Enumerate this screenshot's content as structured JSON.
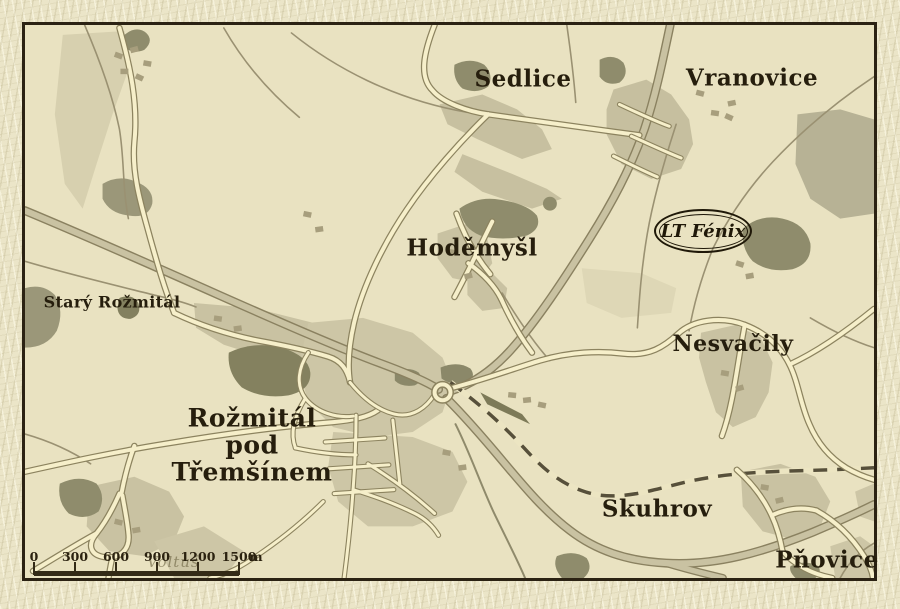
{
  "map": {
    "places": {
      "sedlice": "Sedlice",
      "vranovice": "Vranovice",
      "hodemysl": "Hoděmyšl",
      "stary_rozmital": "Starý Rožmitál",
      "nesvacily": "Nesvačily",
      "rozmital": "Rožmitál\npod\nTřemšínem",
      "skuhrov": "Skuhrov",
      "pnovice": "Pňovice"
    },
    "poi": {
      "label": "LT Fénix"
    },
    "base_label": "Voltuš",
    "colors": {
      "paper": "#ebe5c8",
      "map_background": "#e9e2c1",
      "frame": "#2b2213",
      "road_fill": "#f6efca",
      "road_casing": "#8c835f",
      "major_road_fill": "#c9c2a2",
      "forest": "#8f8c6c",
      "field": "#d7d0af",
      "railway": "#57503b",
      "ink": "#261e0d"
    }
  },
  "scalebar": {
    "ticks": [
      "0",
      "300",
      "600",
      "900",
      "1200",
      "1500"
    ],
    "unit": "m"
  }
}
